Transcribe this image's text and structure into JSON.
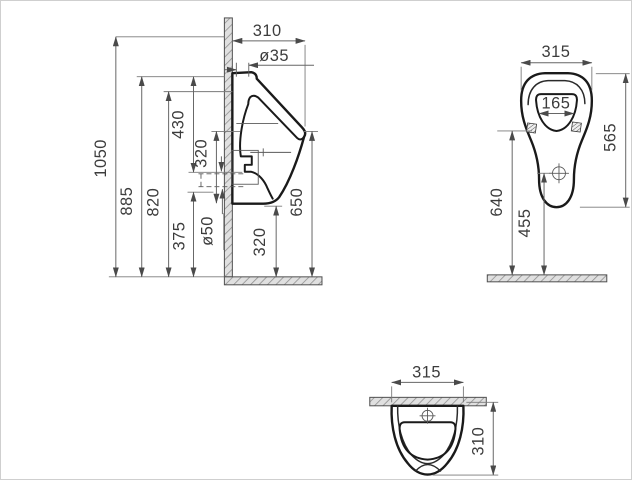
{
  "canvas": {
    "width": 632,
    "height": 480,
    "background": "#ffffff",
    "border_color": "#cfcfcf"
  },
  "colors": {
    "outline": "#1a1a1a",
    "dimension_line": "#666666",
    "text": "#3c3c3c",
    "hatch_fill": "#e0e0e0",
    "hatch_stroke": "#8f8f8f"
  },
  "side_view": {
    "dim_310": "310",
    "dim_dia35": "ø35",
    "dim_1050": "1050",
    "dim_885": "885",
    "dim_820": "820",
    "dim_430": "430",
    "dim_320_upper": "320",
    "dim_375": "375",
    "dim_dia50": "ø50",
    "dim_320_lower": "320",
    "dim_650": "650"
  },
  "front_view": {
    "dim_315": "315",
    "dim_165": "165",
    "dim_565": "565",
    "dim_640": "640",
    "dim_455": "455"
  },
  "top_view": {
    "dim_315": "315",
    "dim_310": "310"
  }
}
